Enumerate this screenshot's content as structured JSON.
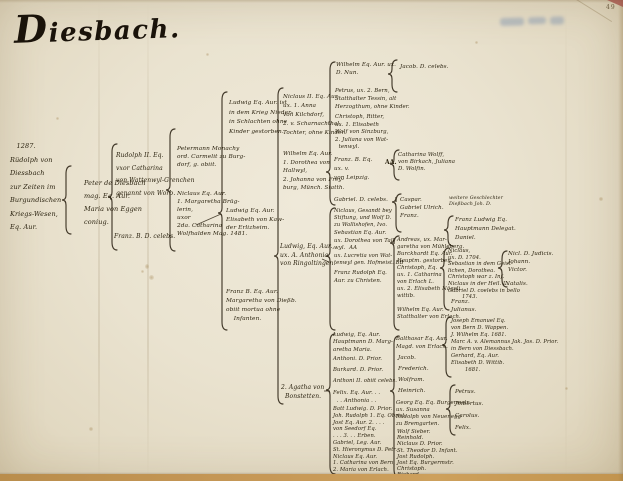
{
  "title": "Diesbach.",
  "page_number": "49",
  "tree": {
    "nodes": [
      {
        "id": "n1",
        "lines": [
          "   1287.",
          "Rüdolph von",
          "Diessbach",
          "zur Zeiten im",
          "Burgundischen",
          "Kriegs-Wesen,",
          "Eq. Aur."
        ]
      },
      {
        "id": "n2",
        "lines": [
          "Peter de Diesbach",
          "mag. Eq. Aur.",
          "Maria von Eggen",
          "coniug."
        ]
      },
      {
        "id": "n3a",
        "lines": [
          "Rudolph II. Eq.",
          "vxor Catharina",
          "von Wattenwyl-Grenchen",
          "genannt von Worb."
        ]
      },
      {
        "id": "n3b",
        "lines": [
          "Franz. B. D. celebs."
        ]
      },
      {
        "id": "n4a",
        "lines": [
          "Petermann Monachy",
          "ord. Carmelit zu Burg-",
          "dorf, g. obiit."
        ]
      },
      {
        "id": "n4b",
        "lines": [
          "Niclaus Eq. Aur.",
          "1. Margaretha Brüg-",
          "lerin,",
          "uxor",
          "2da. Catharina",
          "Wolfhalden Mag. 1481."
        ]
      },
      {
        "id": "n5a",
        "lines": [
          "Ludwig Eq. Aur. ist",
          "in dem Krieg Nieder-",
          "in Schlachten ohne",
          "Kinder gestorben."
        ]
      },
      {
        "id": "n5b",
        "lines": [
          "Ludwig Eq. Aur.",
          "Elisabeth von Kaw-",
          "der Erlizheim."
        ]
      },
      {
        "id": "n5c",
        "lines": [
          "Franz B. Eq. Aur.",
          "Margaretha von Dießb.",
          "obiit mortua ohne",
          "    Infanten."
        ]
      },
      {
        "id": "n6a",
        "lines": [
          "Niclaus II. Eq. Aur.",
          "ux. 1. Anna",
          "von Kilchdorf,",
          "2. v. Scharnachthal,",
          "Tochter, ohne Kinder."
        ]
      },
      {
        "id": "n6b",
        "lines": [
          "Wilhelm Eq. Aur.",
          "1. Dorothea von",
          "Hallwyl,",
          "2. Johanna von Frey-",
          "burg, Münch. Statth."
        ]
      },
      {
        "id": "n6c",
        "lines": [
          "Ludwig, Eq. Aur.,",
          "ux. A. Anthonia",
          "von Ringoltingen."
        ]
      },
      {
        "id": "n6d",
        "lines": [
          "2. Agatha von",
          "  Bonstetten."
        ]
      },
      {
        "id": "n7a",
        "lines": [
          "Wilhelm Eq. Aur. ux.",
          "D. Nun."
        ]
      },
      {
        "id": "n7b",
        "lines": [
          "Petrus, ux. 2. Bern,",
          "Statthalter Tessin, alt",
          "Herzogthum, ohne Kinder."
        ]
      },
      {
        "id": "n7c",
        "lines": [
          "Christoph, Ritter,",
          "ux. 1. Elisabeth",
          "Wolf von Sinzburg,",
          "2. Juliana von Wat-",
          "  tenwyl."
        ]
      },
      {
        "id": "n7d",
        "lines": [
          "Franz. B. Eq.",
          "ux. v.",
          "von Leipzig."
        ]
      },
      {
        "id": "n7e",
        "lines": [
          "Gabriel. D. celebs."
        ]
      },
      {
        "id": "n7f",
        "lines": [
          "Niclaus, Gesandt bey",
          "Stiftung, und Wolf D.",
          "zu Wallishofen, Ivo."
        ]
      },
      {
        "id": "n7g",
        "lines": [
          "Sebastian Eq. Aur.",
          "ux. Dorothea von Tal-",
          "wyl.  AA"
        ]
      },
      {
        "id": "n7h",
        "lines": [
          "ux. Lucretia von Wat-",
          "tenwyl gen. Hofmeist. BB"
        ]
      },
      {
        "id": "n7i",
        "lines": [
          "Franz Rudolph Eq.",
          "Aur. zu Christen."
        ]
      },
      {
        "id": "n7j",
        "lines": [
          "Ludwig, Eq. Aur.",
          "Hauptmann D. Marg-",
          "aretha Maria."
        ]
      },
      {
        "id": "n7k",
        "lines": [
          "Anthoni. D. Prior."
        ]
      },
      {
        "id": "n7l",
        "lines": [
          "Burkard. D. Prior."
        ]
      },
      {
        "id": "n7m",
        "lines": [
          "Anthoni II. obiit celebs."
        ]
      },
      {
        "id": "n7n",
        "lines": [
          "Felix. Eq. Aur. . .",
          "  . . Anthonia . ."
        ]
      },
      {
        "id": "n7o",
        "lines": [
          "Batt Ludwig. D. Prior.",
          "Joh. Rudolph 1. Eq. Obrist.",
          "Jost Eq. Aur. 2. . . .",
          "von Seedorf Eq.",
          ". . . 3. . . Erben.",
          "Gabriel, Leg. Aur.",
          "St. Hieronymus D. Petr.",
          "Niclaus Eq. Aur.",
          "1. Catharina von Bern,",
          "2. Maria von Erlach."
        ]
      },
      {
        "id": "n8a",
        "lines": [
          "Jacob. D. celebs."
        ]
      },
      {
        "id": "n8b",
        "lines": [
          "Catharina Wolff,",
          "von Birkach, Juliana",
          "D. Wolfin."
        ]
      },
      {
        "id": "n8c",
        "lines": [
          "Caspar.",
          "Gabriel Ulrich.",
          "Franz."
        ]
      },
      {
        "id": "n8d",
        "lines": [
          "Andreas, ux. Mar-",
          "garetha von Mühleberg.",
          "Burckhardt Eq. Aur.",
          "Hauptm. gestorben.",
          "Christoph, Eq.",
          "ux. 1. Catharina",
          "von Erlach L.",
          "ux. 2. Elisabeth Nägeli",
          "wittib.",
          "",
          "Wilhelm Eq. Aur.",
          "Statthalter von Erlach."
        ]
      },
      {
        "id": "n8e",
        "lines": [
          "Balthasar Eq. Aur.",
          "Magd. von Erlach."
        ]
      },
      {
        "id": "n8f",
        "lines": [
          "Jacob.",
          "Frederich.",
          "Wolfram.",
          "Heinrich."
        ]
      },
      {
        "id": "n8g",
        "lines": [
          "Georg Eq. Eq. Burgermstr.",
          "ux. Susanna",
          "Rudolph von Neuenegg",
          "zu Bremgarten."
        ]
      },
      {
        "id": "n8h",
        "lines": [
          "Wolf Sieber.",
          "Reinhold.",
          "Niclaus D. Prior.",
          "St. Theodor D. Infant.",
          "Jost Rudolph.",
          "Jost Eq. Burgermstr.",
          "Christoph.",
          "Richard."
        ]
      },
      {
        "id": "n9note",
        "lines": [
          "weitere Geschlechter",
          "Dießbach Joh. D."
        ]
      },
      {
        "id": "n9a",
        "lines": [
          "Franz Ludwig Eq.",
          "Hauptmann Delegat.",
          "Daniel."
        ]
      },
      {
        "id": "n9b",
        "lines": [
          "Niclaus,",
          "ux. D. 1704.",
          "Sebastian in dem Geist-",
          "lichen, Dorothea.",
          "Christoph war z. Inf.",
          "Niclaus in der Heil. L.",
          "Gabriel D. coelebs in bello",
          "        1743."
        ]
      },
      {
        "id": "n9c",
        "lines": [
          "Nicl. D. Judicis.",
          "Johann.",
          "Victor."
        ]
      },
      {
        "id": "n9d",
        "lines": [
          "Natalis."
        ]
      },
      {
        "id": "n9e",
        "lines": [
          "Franz.",
          "Julianus."
        ]
      },
      {
        "id": "n9f",
        "lines": [
          "Joseph Emanuel Eq.",
          "von Bern D. Wappen.",
          "J. Wilhelm Eq. 1681.",
          "Marc A. v. Alemannus Jak. Jos. D. Prior.",
          "in Bern von Diessbach.",
          "Gerhard, Eq. Aur.",
          "Elisabeth D. Wittib.",
          "        1681."
        ]
      },
      {
        "id": "n9g",
        "lines": [
          "Petrus.",
          "Jmbertus.",
          "Carolus.",
          "Felix."
        ]
      },
      {
        "id": "mark1",
        "lines": [
          "AA."
        ]
      }
    ]
  }
}
